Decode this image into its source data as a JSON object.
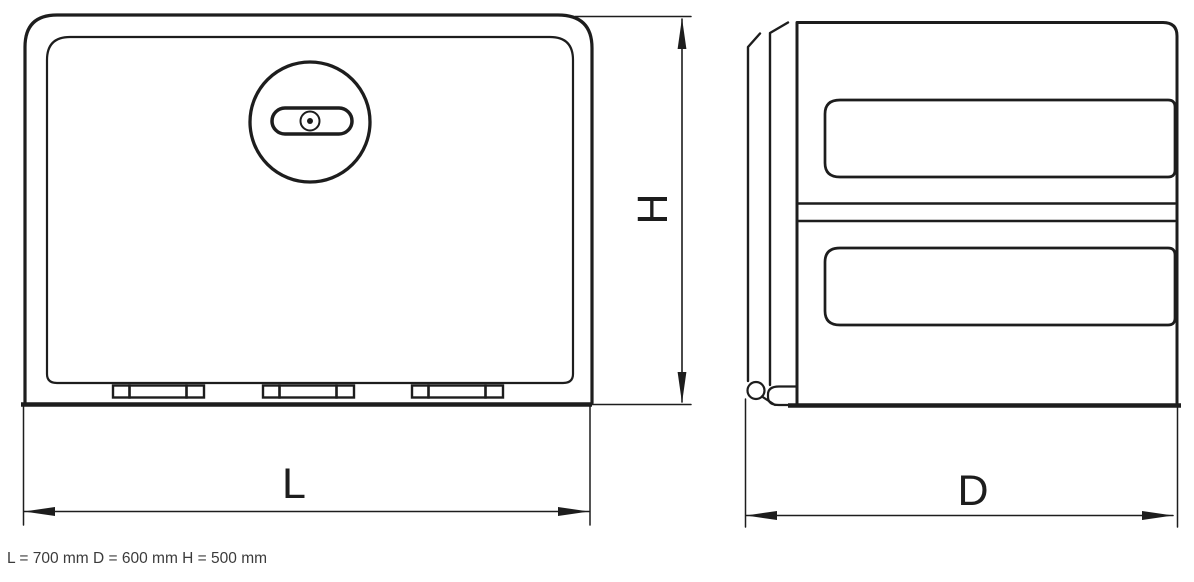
{
  "drawing": {
    "caption": "L = 700 mm D = 600 mm H = 500 mm",
    "labels": {
      "length": "L",
      "height": "H",
      "depth": "D"
    },
    "dimensions_mm": {
      "L": 700,
      "D": 600,
      "H": 500
    },
    "colors": {
      "line": "#1d1d1d",
      "caption_text": "#3b3b3b",
      "background": "#ffffff"
    }
  }
}
